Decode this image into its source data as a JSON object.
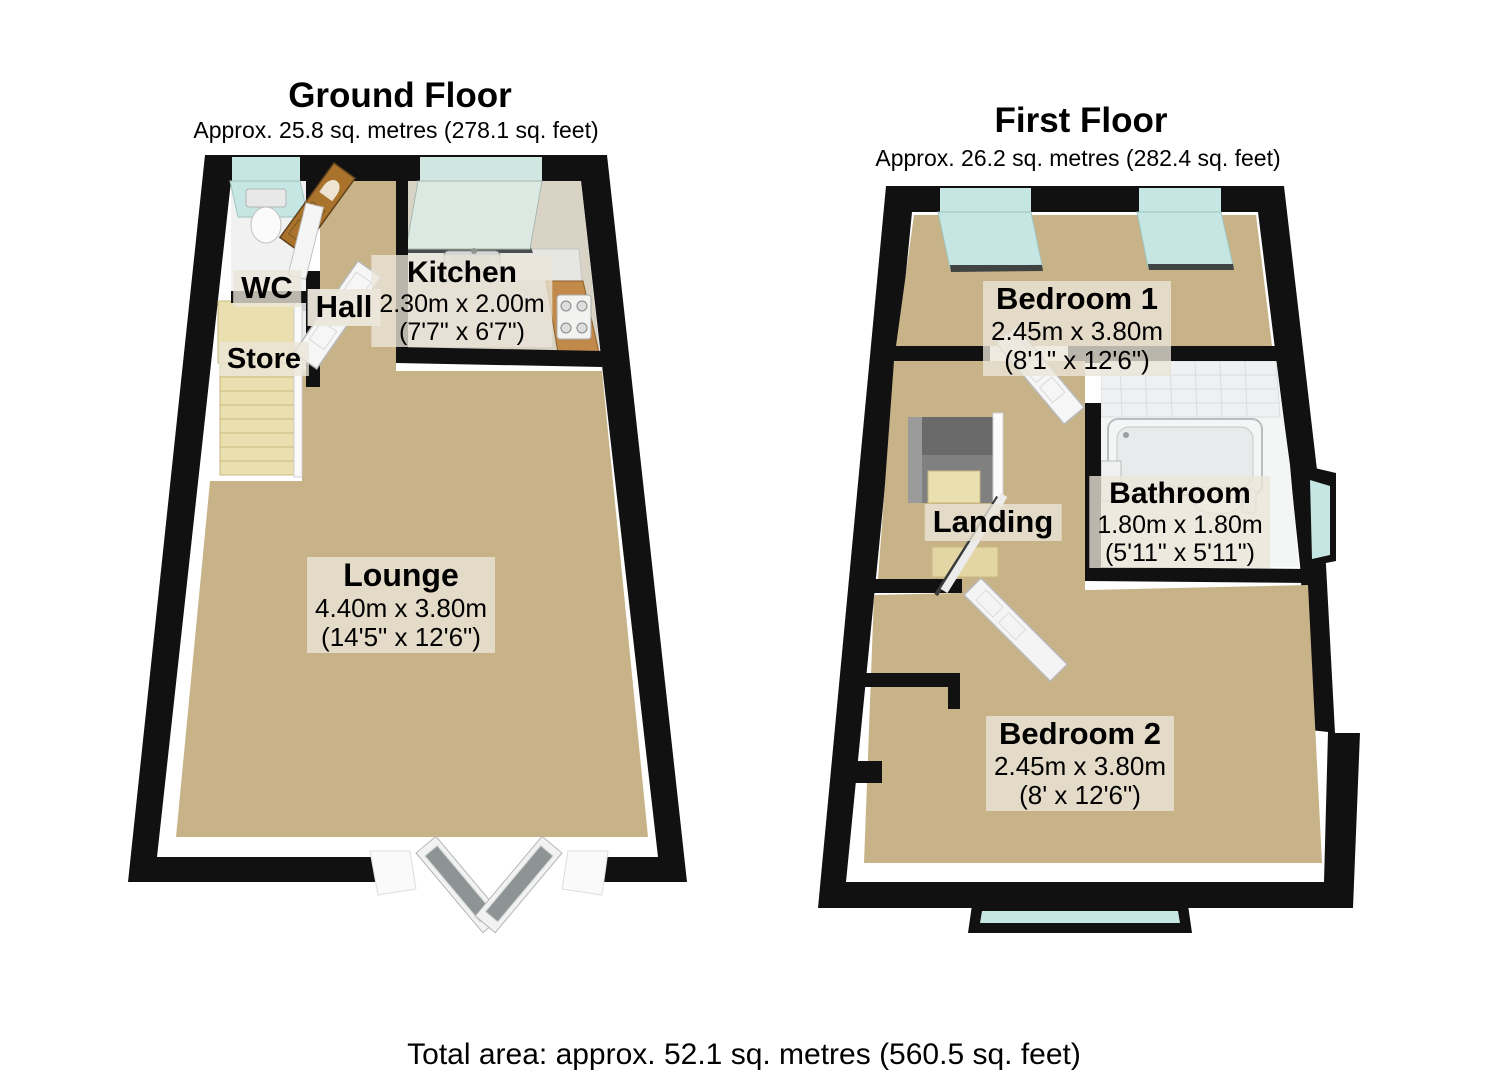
{
  "ground_floor": {
    "title": "Ground Floor",
    "area": "Approx. 25.8 sq. metres (278.1 sq. feet)",
    "rooms": {
      "wc": {
        "name": "WC"
      },
      "hall": {
        "name": "Hall"
      },
      "store": {
        "name": "Store"
      },
      "kitchen": {
        "name": "Kitchen",
        "dims_metric": "2.30m x 2.00m",
        "dims_imperial": "(7'7\" x 6'7\")"
      },
      "lounge": {
        "name": "Lounge",
        "dims_metric": "4.40m x 3.80m",
        "dims_imperial": "(14'5\" x 12'6\")"
      }
    }
  },
  "first_floor": {
    "title": "First Floor",
    "area": "Approx. 26.2 sq. metres (282.4 sq. feet)",
    "rooms": {
      "bedroom1": {
        "name": "Bedroom 1",
        "dims_metric": "2.45m x 3.80m",
        "dims_imperial": "(8'1\" x 12'6\")"
      },
      "landing": {
        "name": "Landing"
      },
      "bathroom": {
        "name": "Bathroom",
        "dims_metric": "1.80m x 1.80m",
        "dims_imperial": "(5'11\" x 5'11\")"
      },
      "bedroom2": {
        "name": "Bedroom 2",
        "dims_metric": "2.45m x 3.80m",
        "dims_imperial": "(8' x 12'6\")"
      }
    }
  },
  "footer": {
    "total_area": "Total area: approx. 52.1 sq. metres (560.5 sq. feet)"
  },
  "colors": {
    "wall": "#111111",
    "carpet": "#c8b388",
    "stairs": "#eadfae",
    "stairs_edge": "#c9b87e",
    "window_glass": "#c5e6e2",
    "kitchen_glass": "#dce9e2",
    "wood_door": "#a9732c",
    "kitchen_floor": "#d9d3c6",
    "counter_wood": "#c28a4a",
    "label_bg": "rgba(234,229,216,0.78)",
    "tile": "#f4f6f6"
  }
}
